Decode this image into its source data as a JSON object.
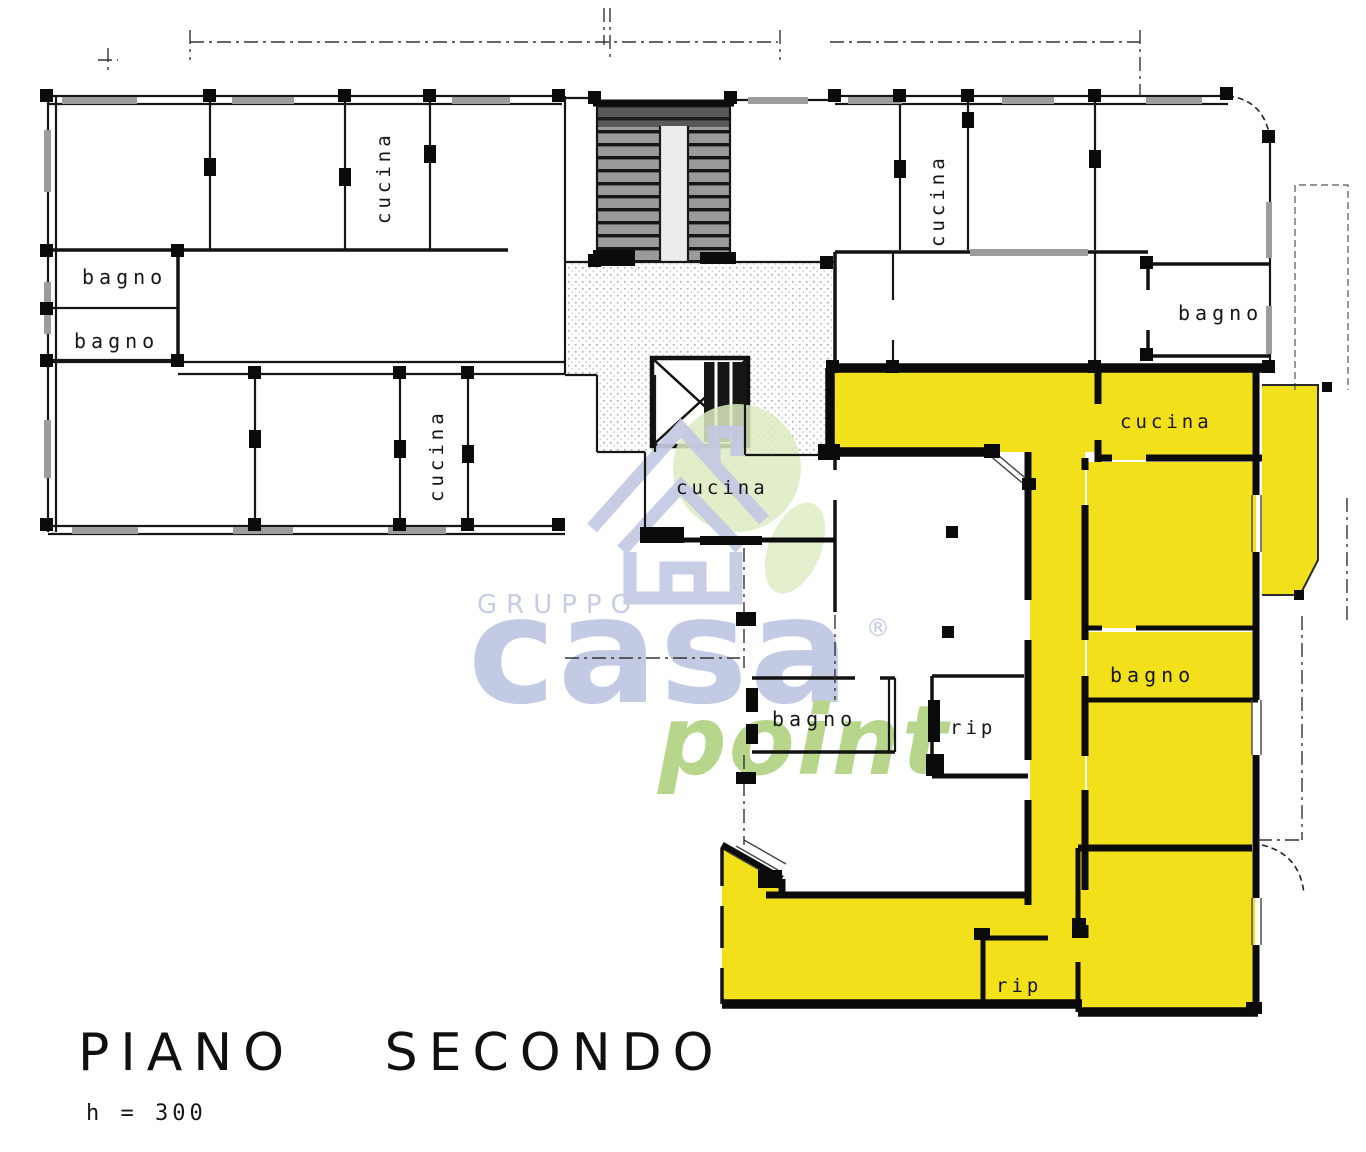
{
  "document": {
    "type": "scanned floor plan",
    "title": "PIANO SECONDO",
    "height_note": "h = 300"
  },
  "colors": {
    "highlight_yellow": "#F2E11A",
    "wall_ink": "#111111",
    "watermark_blue": "#C3CAE3",
    "watermark_green": "#B7D68C",
    "stipple_gray": "#ABABAB"
  },
  "watermark": {
    "gruppo": "GRUPPO",
    "casa": "casa",
    "registered": "®",
    "point": "point"
  },
  "rooms": {
    "cucina_top_left": {
      "label": "cucina"
    },
    "bagno_left_upper": {
      "label": "bagno"
    },
    "bagno_left_lower": {
      "label": "bagno"
    },
    "cucina_left_lower": {
      "label": "cucina"
    },
    "cucina_center": {
      "label": "cucina"
    },
    "cucina_top_right": {
      "label": "cucina"
    },
    "bagno_top_right": {
      "label": "bagno"
    },
    "cucina_highlight": {
      "label": "cucina"
    },
    "bagno_highlight": {
      "label": "bagno"
    },
    "bagno_bottom_center": {
      "label": "bagno"
    },
    "rip_center": {
      "label": "rip"
    },
    "rip_bottom": {
      "label": "rip"
    }
  }
}
